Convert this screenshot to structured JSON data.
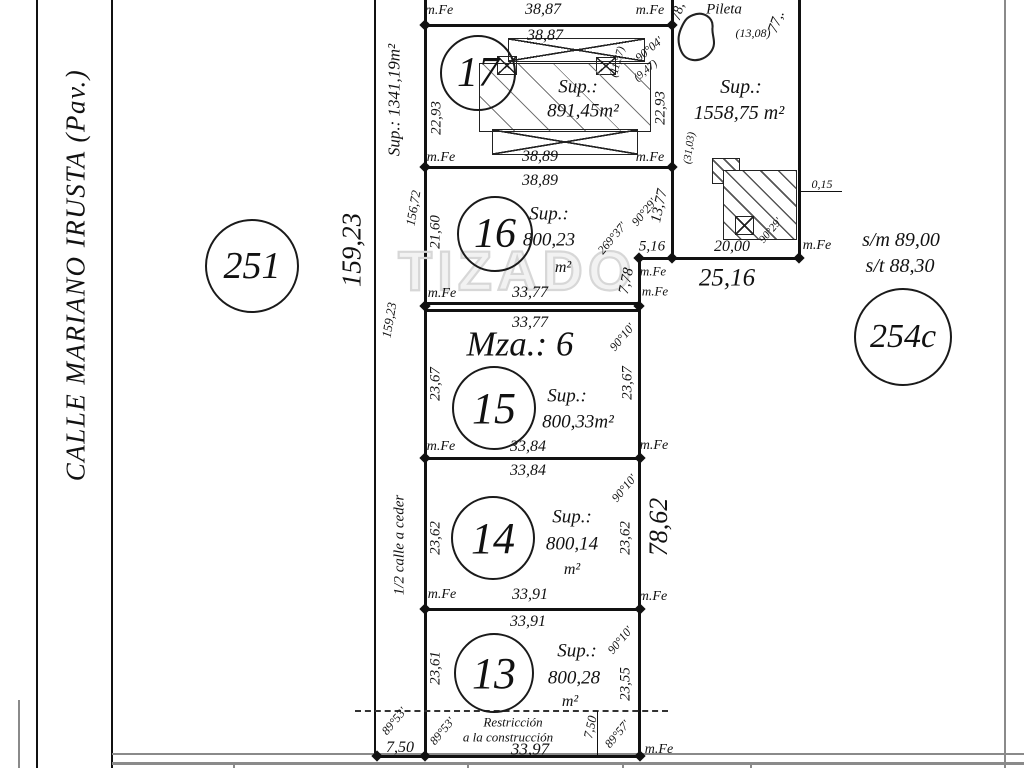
{
  "watermark": "TIZADO",
  "street": {
    "name": "CALLE  MARIANO  IRUSTA  (Pav.)"
  },
  "block_label": "Mza.: 6",
  "circles": [
    {
      "label": "251",
      "cx": 250,
      "cy": 264,
      "r": 45,
      "s": 38
    },
    {
      "label": "17",
      "cx": 476,
      "cy": 71,
      "r": 36,
      "s": 42
    },
    {
      "label": "16",
      "cx": 493,
      "cy": 232,
      "r": 36,
      "s": 42
    },
    {
      "label": "15",
      "cx": 492,
      "cy": 406,
      "r": 40,
      "s": 44
    },
    {
      "label": "14",
      "cx": 491,
      "cy": 536,
      "r": 40,
      "s": 44
    },
    {
      "label": "13",
      "cx": 492,
      "cy": 671,
      "r": 38,
      "s": 44
    },
    {
      "label": "254c",
      "cx": 901,
      "cy": 335,
      "r": 47,
      "s": 34
    }
  ],
  "labels": [
    {
      "t": "m.Fe",
      "x": 439,
      "y": 11,
      "s": 14,
      "n": "mfe-marker"
    },
    {
      "t": "38,87",
      "x": 543,
      "y": 10,
      "s": 16,
      "n": "dim-top-outer"
    },
    {
      "t": "m.Fe",
      "x": 650,
      "y": 11,
      "s": 14,
      "n": "mfe-marker"
    },
    {
      "t": "38,87",
      "x": 545,
      "y": 36,
      "s": 16,
      "n": "lot17-dim-north"
    },
    {
      "t": "22,93",
      "x": 437,
      "y": 118,
      "r": -90,
      "s": 15,
      "n": "lot17-dim-west"
    },
    {
      "t": "Sup.:",
      "x": 578,
      "y": 87,
      "s": 19,
      "n": "lot17-sup-label"
    },
    {
      "t": "891,45m²",
      "x": 583,
      "y": 111,
      "s": 19,
      "n": "lot17-area"
    },
    {
      "t": "(11,57)",
      "x": 618,
      "y": 62,
      "r": -75,
      "s": 11,
      "n": "lot17-aux-dim"
    },
    {
      "t": "(9,47)",
      "x": 646,
      "y": 71,
      "r": -40,
      "s": 11,
      "n": "lot17-aux-dim"
    },
    {
      "t": "90°04'",
      "x": 649,
      "y": 49,
      "r": -40,
      "s": 12,
      "n": "lot17-angle"
    },
    {
      "t": "22,93",
      "x": 661,
      "y": 108,
      "r": -90,
      "s": 15,
      "n": "lot17-dim-east"
    },
    {
      "t": "m.Fe",
      "x": 441,
      "y": 158,
      "s": 14,
      "n": "mfe-marker"
    },
    {
      "t": "38,89",
      "x": 540,
      "y": 157,
      "s": 16,
      "n": "lot17-dim-south"
    },
    {
      "t": "m.Fe",
      "x": 650,
      "y": 158,
      "s": 14,
      "n": "mfe-marker"
    },
    {
      "t": "38,89",
      "x": 540,
      "y": 181,
      "s": 16,
      "n": "lot16-dim-north"
    },
    {
      "t": "156,72",
      "x": 413,
      "y": 208,
      "r": -80,
      "s": 13,
      "n": "block-west-dim"
    },
    {
      "t": "21,60",
      "x": 436,
      "y": 232,
      "r": -90,
      "s": 15,
      "n": "lot16-dim-west"
    },
    {
      "t": "Sup.:",
      "x": 549,
      "y": 214,
      "s": 19,
      "n": "lot16-sup-label"
    },
    {
      "t": "800,23",
      "x": 549,
      "y": 240,
      "s": 19,
      "n": "lot16-area"
    },
    {
      "t": "m²",
      "x": 563,
      "y": 268,
      "s": 16,
      "n": "lot16-area-unit"
    },
    {
      "t": "90°29'",
      "x": 644,
      "y": 212,
      "r": -50,
      "s": 12,
      "n": "lot16-angle"
    },
    {
      "t": "269°37'",
      "x": 612,
      "y": 238,
      "r": -50,
      "s": 12,
      "n": "lot16-angle-reflex"
    },
    {
      "t": "13,77",
      "x": 660,
      "y": 206,
      "r": -78,
      "s": 15,
      "n": "lot16-dim-east-1"
    },
    {
      "t": "5,16",
      "x": 652,
      "y": 247,
      "s": 15,
      "n": "lot16-dim-jog"
    },
    {
      "t": "7,78",
      "x": 627,
      "y": 281,
      "r": -78,
      "s": 15,
      "n": "lot16-dim-east-2"
    },
    {
      "t": "m.Fe",
      "x": 653,
      "y": 271,
      "s": 13,
      "n": "mfe-marker"
    },
    {
      "t": "m.Fe",
      "x": 655,
      "y": 291,
      "s": 13,
      "n": "mfe-marker"
    },
    {
      "t": "m.Fe",
      "x": 442,
      "y": 294,
      "s": 14,
      "n": "mfe-marker"
    },
    {
      "t": "33,77",
      "x": 530,
      "y": 293,
      "s": 16,
      "n": "lot16-dim-south"
    },
    {
      "t": "33,77",
      "x": 530,
      "y": 323,
      "s": 16,
      "n": "lot15-dim-north"
    },
    {
      "t": "Mza.: 6",
      "x": 520,
      "y": 344,
      "s": 35,
      "n": "block-label"
    },
    {
      "t": "90°10'",
      "x": 622,
      "y": 337,
      "r": -50,
      "s": 12,
      "n": "lot15-angle"
    },
    {
      "t": "23,67",
      "x": 436,
      "y": 384,
      "r": -90,
      "s": 15,
      "n": "lot15-dim-west"
    },
    {
      "t": "23,67",
      "x": 628,
      "y": 383,
      "r": -90,
      "s": 15,
      "n": "lot15-dim-east"
    },
    {
      "t": "Sup.:",
      "x": 567,
      "y": 396,
      "s": 19,
      "n": "lot15-sup-label"
    },
    {
      "t": "800,33m²",
      "x": 578,
      "y": 422,
      "s": 19,
      "n": "lot15-area"
    },
    {
      "t": "m.Fe",
      "x": 441,
      "y": 447,
      "s": 14,
      "n": "mfe-marker"
    },
    {
      "t": "33,84",
      "x": 528,
      "y": 447,
      "s": 16,
      "n": "lot15-dim-south"
    },
    {
      "t": "m.Fe",
      "x": 654,
      "y": 446,
      "s": 14,
      "n": "mfe-marker"
    },
    {
      "t": "33,84",
      "x": 528,
      "y": 471,
      "s": 16,
      "n": "lot14-dim-north"
    },
    {
      "t": "90°10'",
      "x": 624,
      "y": 488,
      "r": -50,
      "s": 12,
      "n": "lot14-angle"
    },
    {
      "t": "23,62",
      "x": 436,
      "y": 538,
      "r": -90,
      "s": 15,
      "n": "lot14-dim-west"
    },
    {
      "t": "23,62",
      "x": 626,
      "y": 538,
      "r": -90,
      "s": 15,
      "n": "lot14-dim-east"
    },
    {
      "t": "Sup.:",
      "x": 572,
      "y": 517,
      "s": 19,
      "n": "lot14-sup-label"
    },
    {
      "t": "800,14",
      "x": 572,
      "y": 544,
      "s": 19,
      "n": "lot14-area"
    },
    {
      "t": "m²",
      "x": 572,
      "y": 570,
      "s": 16,
      "n": "lot14-area-unit"
    },
    {
      "t": "78,62",
      "x": 659,
      "y": 527,
      "r": -90,
      "s": 26,
      "n": "block-east-dim"
    },
    {
      "t": "m.Fe",
      "x": 442,
      "y": 595,
      "s": 14,
      "n": "mfe-marker"
    },
    {
      "t": "33,91",
      "x": 530,
      "y": 595,
      "s": 16,
      "n": "lot14-dim-south"
    },
    {
      "t": "m.Fe",
      "x": 653,
      "y": 597,
      "s": 14,
      "n": "mfe-marker"
    },
    {
      "t": "33,91",
      "x": 528,
      "y": 622,
      "s": 16,
      "n": "lot13-dim-north"
    },
    {
      "t": "90°10'",
      "x": 620,
      "y": 640,
      "r": -50,
      "s": 12,
      "n": "lot13-angle"
    },
    {
      "t": "23,61",
      "x": 436,
      "y": 668,
      "r": -90,
      "s": 15,
      "n": "lot13-dim-west"
    },
    {
      "t": "23,55",
      "x": 626,
      "y": 684,
      "r": -90,
      "s": 15,
      "n": "lot13-dim-east"
    },
    {
      "t": "Sup.:",
      "x": 577,
      "y": 651,
      "s": 19,
      "n": "lot13-sup-label"
    },
    {
      "t": "800,28",
      "x": 574,
      "y": 678,
      "s": 19,
      "n": "lot13-area"
    },
    {
      "t": "m²",
      "x": 570,
      "y": 702,
      "s": 16,
      "n": "lot13-area-unit"
    },
    {
      "t": "Restricción",
      "x": 513,
      "y": 722,
      "s": 13,
      "n": "restriction-label-1"
    },
    {
      "t": "a la construcción",
      "x": 508,
      "y": 737,
      "s": 13,
      "n": "restriction-label-2"
    },
    {
      "t": "33,97",
      "x": 530,
      "y": 749,
      "s": 17,
      "n": "lot13-dim-south"
    },
    {
      "t": "7,50",
      "x": 590,
      "y": 727,
      "r": -78,
      "s": 13,
      "n": "restriction-depth"
    },
    {
      "t": "89°53'",
      "x": 442,
      "y": 731,
      "r": -50,
      "s": 12,
      "n": "lot13-angle-sw"
    },
    {
      "t": "89°57'",
      "x": 617,
      "y": 734,
      "r": -50,
      "s": 12,
      "n": "lot13-angle-se"
    },
    {
      "t": "m.Fe",
      "x": 659,
      "y": 750,
      "s": 14,
      "n": "mfe-marker"
    },
    {
      "t": "Sup.: 1341,19m²",
      "x": 394,
      "y": 100,
      "r": -90,
      "s": 17,
      "n": "strip-area"
    },
    {
      "t": "159,23",
      "x": 389,
      "y": 320,
      "r": -80,
      "s": 13,
      "n": "strip-dim"
    },
    {
      "t": "1/2 calle a ceder",
      "x": 400,
      "y": 545,
      "r": -90,
      "s": 15,
      "n": "strip-label"
    },
    {
      "t": "89°53'",
      "x": 394,
      "y": 721,
      "r": -50,
      "s": 12,
      "n": "strip-angle"
    },
    {
      "t": "7,50",
      "x": 400,
      "y": 748,
      "s": 16,
      "n": "strip-width-dim"
    },
    {
      "t": "159,23",
      "x": 352,
      "y": 250,
      "r": -90,
      "s": 27,
      "n": "west-boundary-dim"
    },
    {
      "t": "CALLE  MARIANO  IRUSTA  (Pav.)",
      "x": 76,
      "y": 275,
      "r": -90,
      "s": 27,
      "ls": 1.5,
      "n": "street-name"
    },
    {
      "t": "78,",
      "x": 679,
      "y": 12,
      "r": -75,
      "s": 14,
      "n": "pileta-dim-west-partial"
    },
    {
      "t": "Pileta",
      "x": 724,
      "y": 10,
      "s": 15,
      "n": "pileta-label"
    },
    {
      "t": "77,.",
      "x": 777,
      "y": 22,
      "r": -70,
      "s": 15,
      "n": "pileta-dim-east-partial"
    },
    {
      "t": "(13,08)",
      "x": 753,
      "y": 33,
      "s": 12,
      "n": "pileta-aux-dim"
    },
    {
      "t": "Sup.:",
      "x": 741,
      "y": 87,
      "s": 20,
      "n": "pileta-sup-label"
    },
    {
      "t": "1558,75 m²",
      "x": 739,
      "y": 113,
      "s": 20,
      "n": "pileta-area"
    },
    {
      "t": "(31,03)",
      "x": 690,
      "y": 148,
      "r": -82,
      "s": 11,
      "n": "pileta-aux-dim-2"
    },
    {
      "t": "20,00",
      "x": 732,
      "y": 247,
      "s": 16,
      "n": "pileta-building-dim"
    },
    {
      "t": "90°29'",
      "x": 771,
      "y": 231,
      "r": -50,
      "s": 11,
      "n": "pileta-angle"
    },
    {
      "t": "0,15",
      "x": 822,
      "y": 184,
      "s": 12,
      "n": "building-offset-dim"
    },
    {
      "t": "m.Fe",
      "x": 817,
      "y": 246,
      "s": 14,
      "n": "mfe-marker"
    },
    {
      "t": "25,16",
      "x": 727,
      "y": 278,
      "s": 25,
      "n": "dim-25-16"
    },
    {
      "t": "s/m 89,00",
      "x": 901,
      "y": 240,
      "s": 20,
      "n": "level-sm"
    },
    {
      "t": "s/t  88,30",
      "x": 900,
      "y": 266,
      "s": 20,
      "n": "level-st"
    }
  ]
}
